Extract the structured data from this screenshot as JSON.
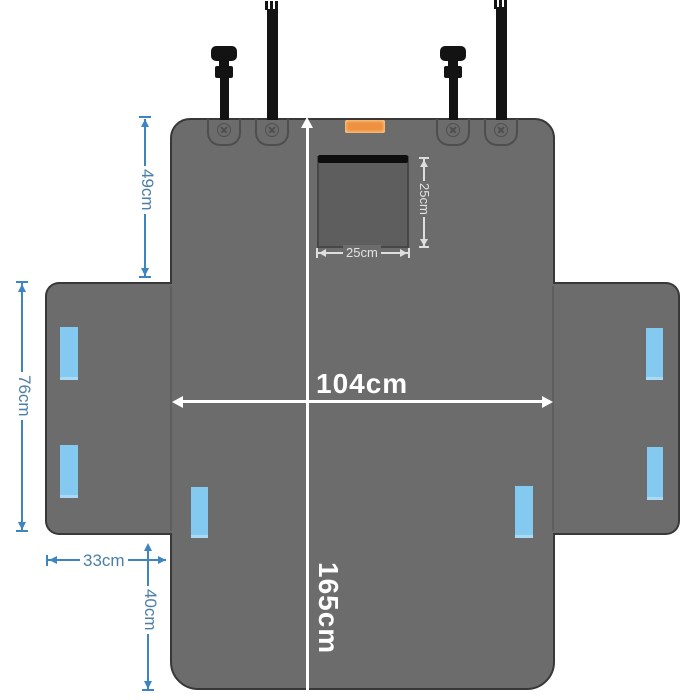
{
  "diagram": {
    "description": "Pet car back-seat cover dimension diagram, cross-shaped gray cover laid flat",
    "dimensions": {
      "back_panel_height": "49cm",
      "side_flap_length": "76cm",
      "side_flap_width": "33cm",
      "front_drop": "40cm",
      "cover_width": "104cm",
      "cover_total_length": "165cm",
      "window_width": "25cm",
      "window_height": "25cm"
    },
    "features": {
      "strap_count": 4,
      "snap_tab_count": 4,
      "velcro_strip_count": 6,
      "mesh_window": "square viewing window with zipper bar"
    },
    "colors": {
      "cover_fill": "#6c6c6c",
      "cover_border": "#383838",
      "mesh_window_fill": "#5e5e5e",
      "zipper": "#0e0e0e",
      "velcro_strip": "#84c9f0",
      "brand_label": "#ee9140",
      "dimension_blue": "#3d85c2",
      "dimension_white": "#ffffff",
      "strap": "#131313",
      "background": "#ffffff"
    }
  }
}
